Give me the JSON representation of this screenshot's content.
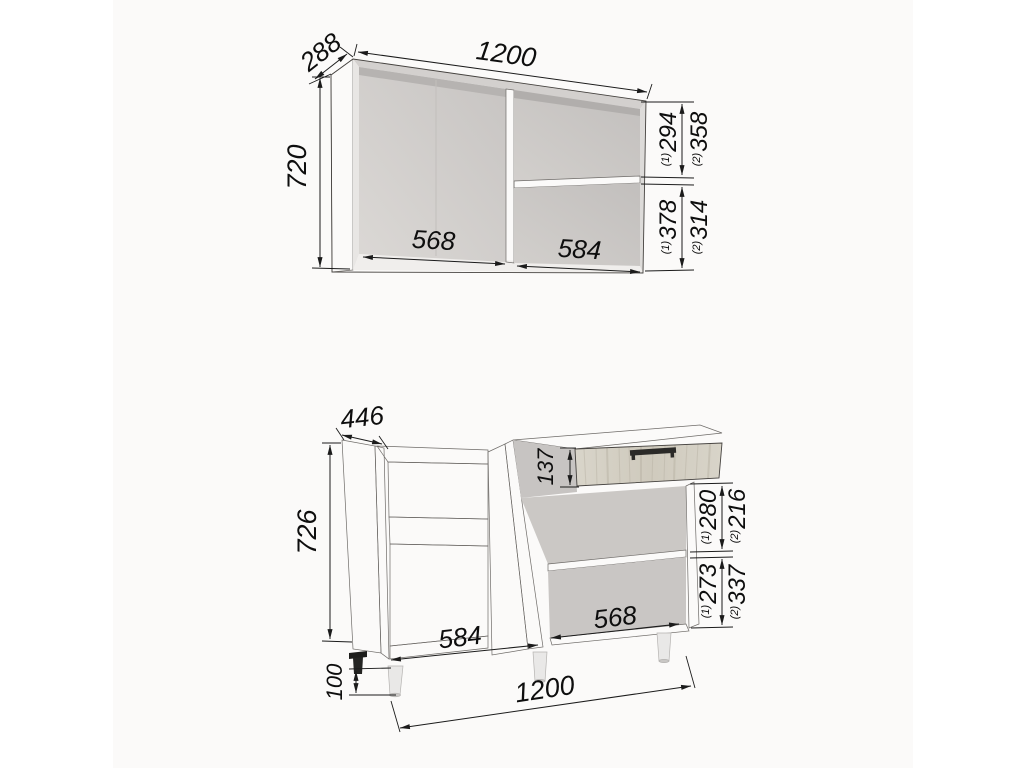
{
  "meta": {
    "title": "Kitchen cabinet set dimension drawing",
    "background": "#ffffff",
    "panel_background": "#fbfaf9",
    "line_color": "#1b1b1b",
    "text_color": "#0e0e0e",
    "carcass_color": "#d7d4d2",
    "interior_color": "#c9c6c4",
    "white_edge_color": "#f2f1ef",
    "wood_color": "#d6d2c6",
    "handle_color": "#2b2a28"
  },
  "wall_cabinet": {
    "width": "1200",
    "depth": "288",
    "height": "720",
    "left_opening_width": "568",
    "right_opening_width": "584",
    "upper_height_v1": "294",
    "upper_height_v2": "358",
    "lower_height_v1": "378",
    "lower_height_v2": "314",
    "variant1_mark": "(1)",
    "variant2_mark": "(2)"
  },
  "base_cabinet": {
    "width": "1200",
    "depth": "446",
    "height": "726",
    "leg_height": "100",
    "drawer_front_height": "137",
    "left_opening_width": "584",
    "right_opening_width": "568",
    "upper_height_v1": "280",
    "upper_height_v2": "216",
    "lower_height_v1": "273",
    "lower_height_v2": "337",
    "variant1_mark": "(1)",
    "variant2_mark": "(2)"
  }
}
